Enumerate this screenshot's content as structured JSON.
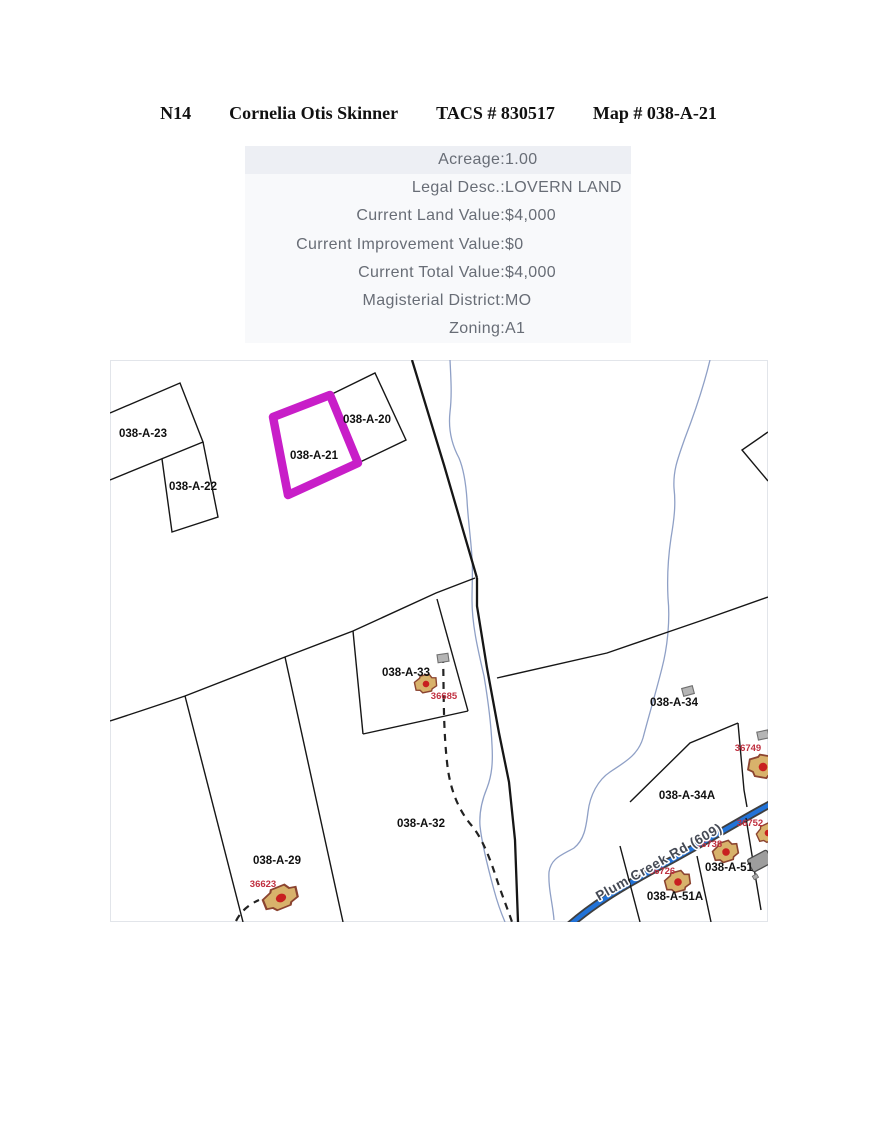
{
  "title": {
    "n_code": "N14",
    "owner": "Cornelia Otis Skinner",
    "tacs": "TACS # 830517",
    "map_ref": "Map # 038-A-21"
  },
  "property_info": {
    "rows": [
      {
        "label": "Acreage:",
        "value": "1.00"
      },
      {
        "label": "Legal Desc.:",
        "value": "LOVERN LAND"
      },
      {
        "label": "Current Land Value:",
        "value": "$4,000"
      },
      {
        "label": "Current Improvement Value:",
        "value": "$0"
      },
      {
        "label": "Current Total Value:",
        "value": "$4,000"
      },
      {
        "label": "Magisterial District:",
        "value": "MO"
      },
      {
        "label": "Zoning:",
        "value": "A1"
      }
    ]
  },
  "map": {
    "highlight_color": "#c81ec8",
    "creek_color": "#8fa0c6",
    "road_color": "#2273d8",
    "road_label": "Plum Creek Rd (609)",
    "highlighted_parcel": "038-A-21",
    "parcel_labels": [
      "038-A-23",
      "038-A-22",
      "038-A-21",
      "038-A-20",
      "038-A-33",
      "038-A-34",
      "038-A-34A",
      "038-A-32",
      "038-A-29",
      "038-A-51",
      "038-A-51A"
    ],
    "house_numbers": [
      "36685",
      "36623",
      "36749",
      "36752",
      "36738",
      "36726"
    ]
  }
}
